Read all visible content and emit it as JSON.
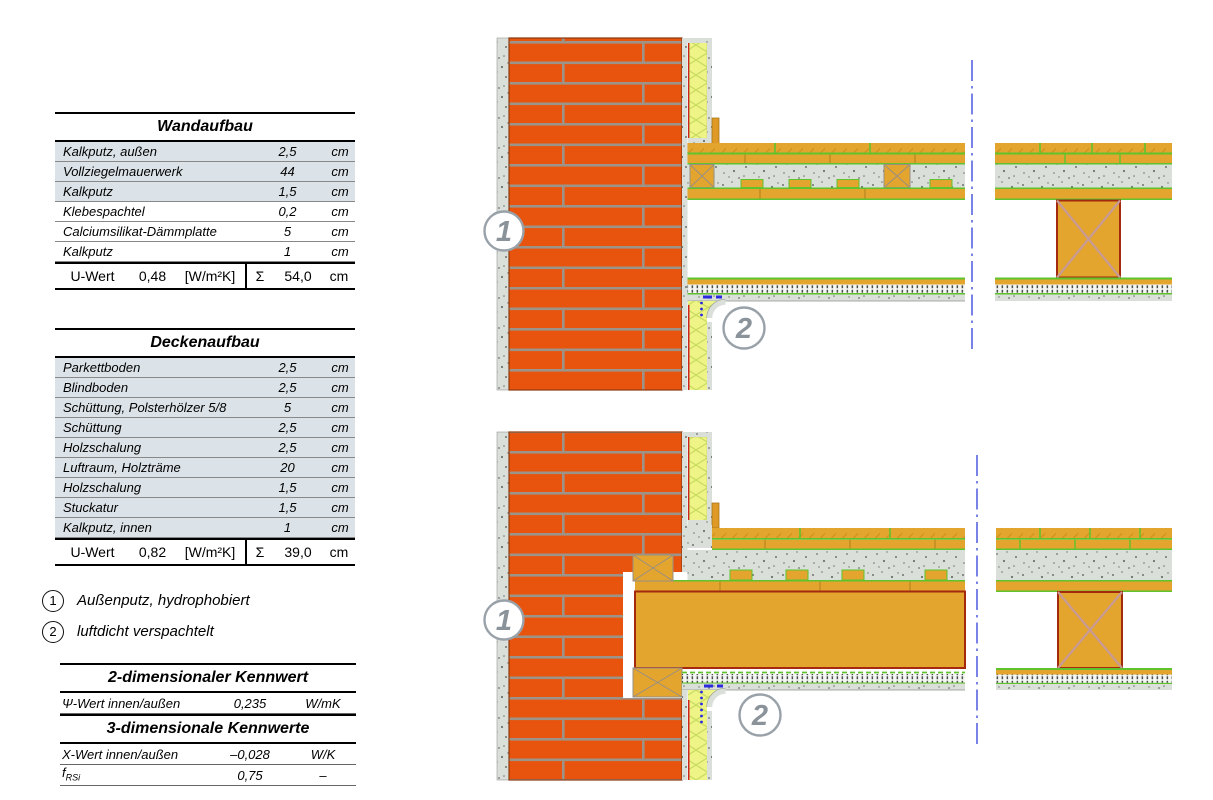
{
  "wall_table": {
    "title": "Wandaufbau",
    "rows": [
      {
        "name": "Kalkputz, außen",
        "value": "2,5",
        "unit": "cm",
        "shaded": true
      },
      {
        "name": "Vollziegelmauerwerk",
        "value": "44",
        "unit": "cm",
        "shaded": true
      },
      {
        "name": "Kalkputz",
        "value": "1,5",
        "unit": "cm",
        "shaded": true
      },
      {
        "name": "Klebespachtel",
        "value": "0,2",
        "unit": "cm",
        "shaded": false
      },
      {
        "name": "Calciumsilikat-Dämmplatte",
        "value": "5",
        "unit": "cm",
        "shaded": false
      },
      {
        "name": "Kalkputz",
        "value": "1",
        "unit": "cm",
        "shaded": false
      }
    ],
    "summary": {
      "label": "U-Wert",
      "value": "0,48",
      "unit": "[W/m²K]",
      "sigma": "Σ",
      "total": "54,0",
      "total_unit": "cm"
    }
  },
  "ceiling_table": {
    "title": "Deckenaufbau",
    "rows": [
      {
        "name": "Parkettboden",
        "value": "2,5",
        "unit": "cm",
        "shaded": true
      },
      {
        "name": "Blindboden",
        "value": "2,5",
        "unit": "cm",
        "shaded": true
      },
      {
        "name": "Schüttung, Polsterhölzer 5/8",
        "value": "5",
        "unit": "cm",
        "shaded": true
      },
      {
        "name": "Schüttung",
        "value": "2,5",
        "unit": "cm",
        "shaded": true
      },
      {
        "name": "Holzschalung",
        "value": "2,5",
        "unit": "cm",
        "shaded": true
      },
      {
        "name": "Luftraum, Holzträme",
        "value": "20",
        "unit": "cm",
        "shaded": true
      },
      {
        "name": "Holzschalung",
        "value": "1,5",
        "unit": "cm",
        "shaded": true
      },
      {
        "name": "Stuckatur",
        "value": "1,5",
        "unit": "cm",
        "shaded": true
      },
      {
        "name": "Kalkputz, innen",
        "value": "1",
        "unit": "cm",
        "shaded": true
      }
    ],
    "summary": {
      "label": "U-Wert",
      "value": "0,82",
      "unit": "[W/m²K]",
      "sigma": "Σ",
      "total": "39,0",
      "total_unit": "cm"
    }
  },
  "legend": [
    {
      "num": "1",
      "text": "Außenputz, hydrophobiert"
    },
    {
      "num": "2",
      "text": "luftdicht verspachtelt"
    }
  ],
  "kennwert_2d": {
    "title": "2-dimensionaler Kennwert",
    "rows": [
      {
        "name": "Ψ-Wert innen/außen",
        "value": "0,235",
        "unit": "W/mK"
      }
    ]
  },
  "kennwert_3d": {
    "title": "3-dimensionale Kennwerte",
    "rows": [
      {
        "name": "Χ-Wert innen/außen",
        "value": "–0,028",
        "unit": "W/K"
      },
      {
        "name_base": "f",
        "name_sub": "RSi",
        "value": "0,75",
        "unit": "–"
      }
    ]
  },
  "drawings": {
    "callout_1": "1",
    "callout_2": "2"
  },
  "colors": {
    "brick": "#E8540E",
    "mortar": "#9C9488",
    "wood": "#E3A52D",
    "wood_hatch": "#CE8F1D",
    "insulation": "#EFF487",
    "insulation_hatch": "#C8DC60",
    "plaster": "#DADFDA",
    "green_layer": "#5FC32E",
    "beam_border": "#A3290F",
    "adhesive_red": "#CC2222",
    "seal_blue": "#2A2ADF",
    "section_line": "#5864DF",
    "callout_gray": "#8A929A",
    "table_shade": "#DCE3E8"
  }
}
